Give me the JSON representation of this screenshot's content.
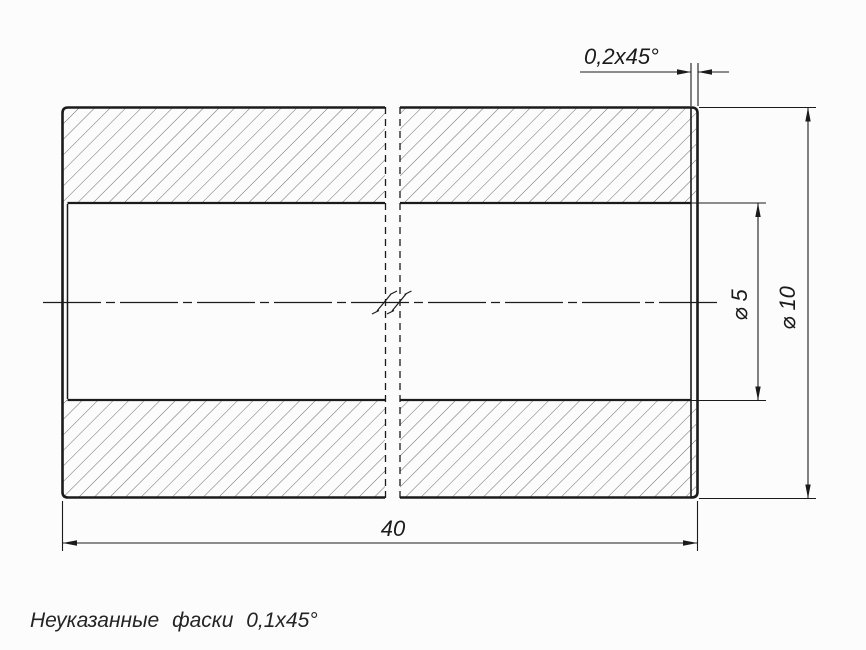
{
  "drawing": {
    "dimensions": {
      "length": {
        "label": "40",
        "value": 40
      },
      "outer_diameter": {
        "label": "⌀ 10",
        "value": 10
      },
      "bore_diameter": {
        "label": "⌀ 5",
        "value": 5
      },
      "chamfer": {
        "label": "0,2x45°"
      }
    },
    "note": "Неуказанные фаски 0,1x45°",
    "colors": {
      "ink": "#1b1b1b",
      "hatch_line": "#5a5a5a",
      "background": "#fcfcfc"
    }
  }
}
